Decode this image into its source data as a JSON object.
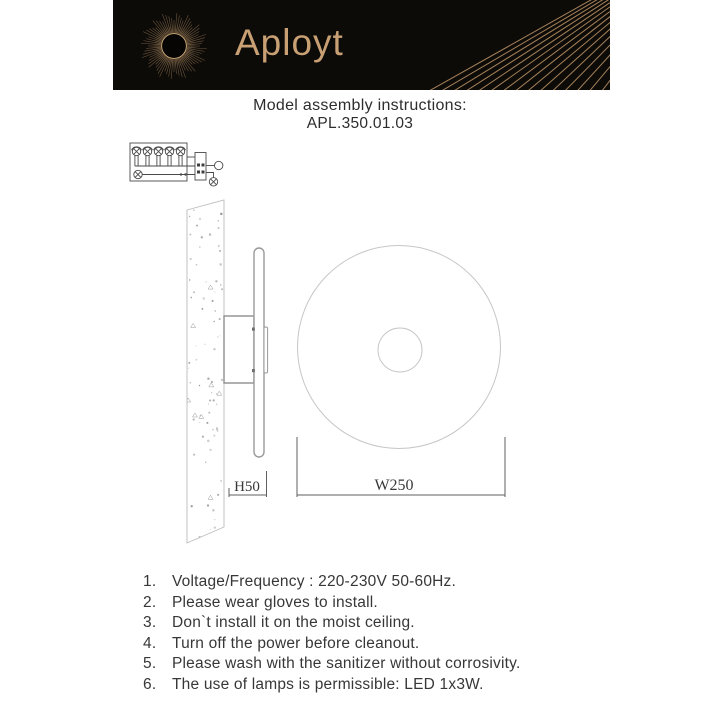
{
  "header": {
    "brand": "Aployt"
  },
  "title": {
    "line1": "Model assembly instructions:",
    "line2": "APL.350.01.03"
  },
  "drawing": {
    "dimension_height": "H50",
    "dimension_width": "W250"
  },
  "instructions": {
    "items": [
      {
        "num": "1.",
        "text": "Voltage/Frequency : 220-230V 50-60Hz."
      },
      {
        "num": "2.",
        "text": "Please wear gloves to install."
      },
      {
        "num": "3.",
        "text": "Don`t install it on the moist ceiling."
      },
      {
        "num": "4.",
        "text": "Turn off the power before cleanout."
      },
      {
        "num": "5.",
        "text": "Please wash with the sanitizer without corrosivity."
      },
      {
        "num": "6.",
        "text": "The use of lamps is permissible: LED 1x3W."
      }
    ]
  },
  "colors": {
    "banner_bg": "#0d0b08",
    "accent_gold": "#c8a074",
    "text_dark": "#373737",
    "drawing_line": "#c6c6c6"
  }
}
